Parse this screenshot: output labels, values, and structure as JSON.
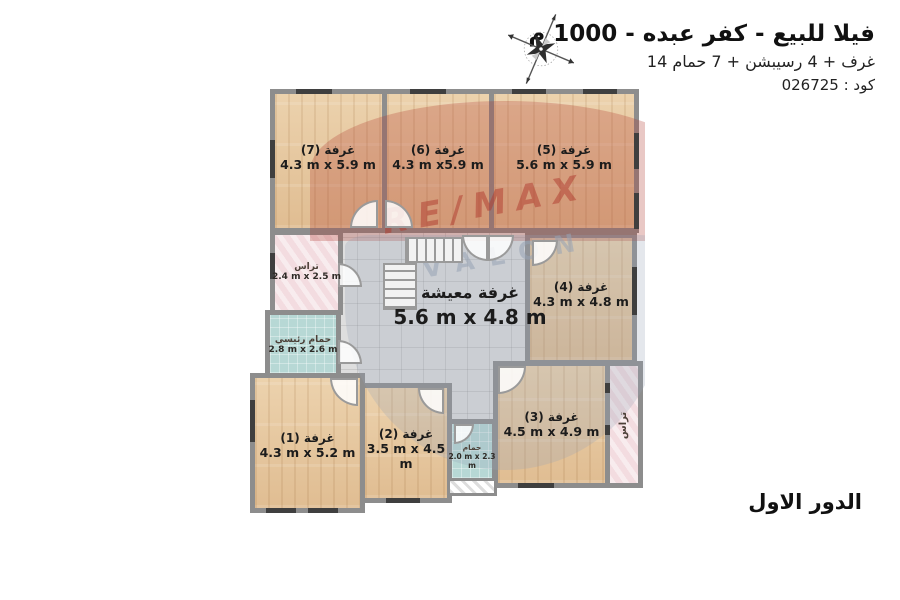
{
  "header": {
    "title": "فيلا للبيع - كفر عبده - 1000 م",
    "subtitle": "14 غرف + 4 رسيبشن + 7 حمام",
    "code": "كود : 026725"
  },
  "footer": {
    "floor_label": "الدور الاول"
  },
  "watermark": {
    "brand": "RE/MAX",
    "sub_brand": "AVALON"
  },
  "icons": {
    "compass": "compass-rose-icon"
  },
  "rooms": {
    "room7": {
      "label": "غرفة (7)",
      "dims": "4.3 m x 5.9 m"
    },
    "room6": {
      "label": "غرفة (6)",
      "dims": "4.3 m x5.9 m"
    },
    "room5": {
      "label": "غرفة (5)",
      "dims": "5.6 m x 5.9 m"
    },
    "room4": {
      "label": "غرفة (4)",
      "dims": "4.3 m x 4.8 m"
    },
    "room3": {
      "label": "غرفة (3)",
      "dims": "4.5 m x 4.9 m"
    },
    "room2": {
      "label": "غرفة (2)",
      "dims": "3.5 m x 4.5 m"
    },
    "room1": {
      "label": "غرفة (1)",
      "dims": "4.3 m x 5.2 m"
    },
    "living": {
      "label": "غرفة معيشة",
      "dims": "5.6 m x 4.8 m"
    },
    "terrace_left": {
      "label": "تراس",
      "dims": "2.4 m x 2.5 m"
    },
    "terrace_right": {
      "label": "تراس",
      "dims": ""
    },
    "bath_main": {
      "label": "حمام رئيسي",
      "dims": "2.8 m x 2.6 m"
    },
    "bath_small": {
      "label": "حمام",
      "dims": "2.0 m x 2.3 m"
    }
  },
  "colors": {
    "wood": "#e6c49c",
    "tile": "#dedede",
    "terrace": "#f3dce0",
    "bath": "#b7d8d5",
    "wall": "#8d8d8d",
    "watermark_red": "#b03a2e",
    "watermark_gray": "#98a4b5"
  }
}
